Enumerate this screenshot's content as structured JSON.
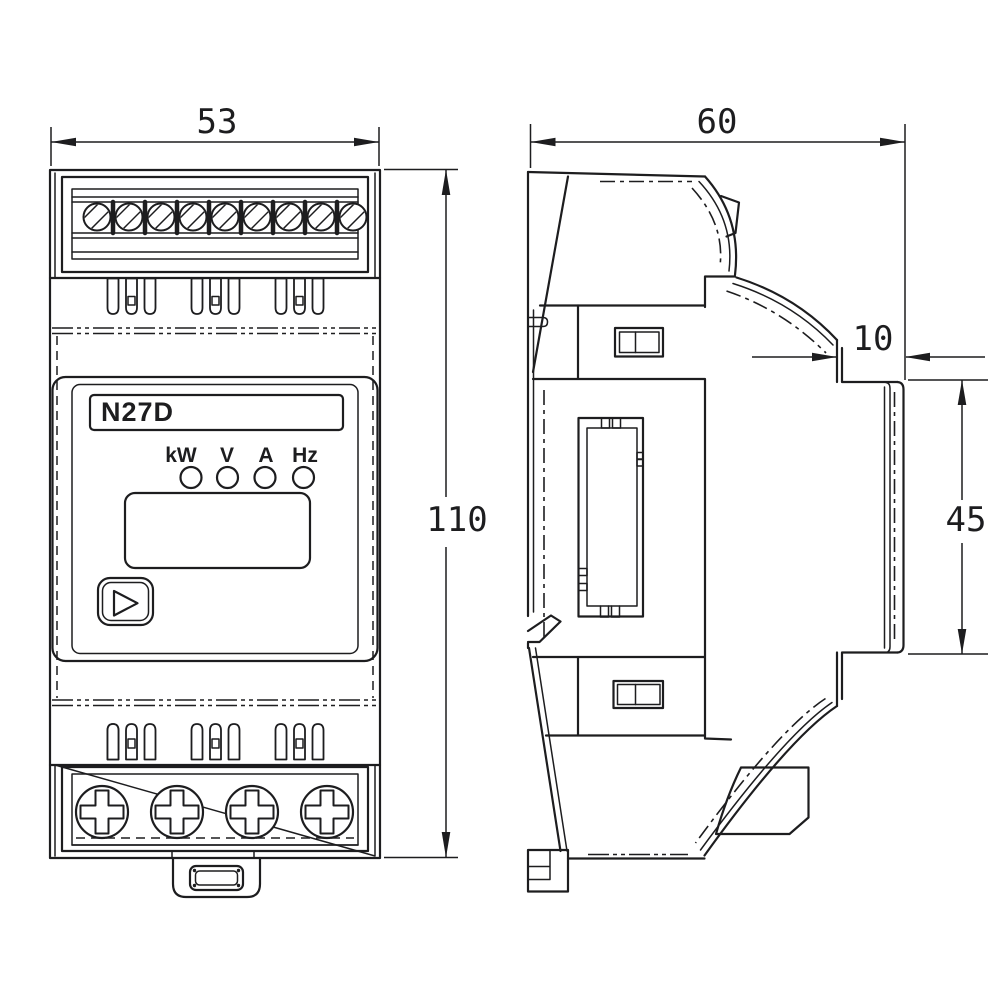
{
  "drawing": {
    "ink_color": "#1d1d1f",
    "background_color": "#ffffff",
    "front_view": {
      "model_label": "N27D",
      "indicators": [
        "kW",
        "V",
        "A",
        "Hz"
      ],
      "width_dim": "53",
      "height_dim": "110"
    },
    "side_view": {
      "depth_dim": "60",
      "front_depth_dim": "10",
      "front_height_dim": "45"
    }
  }
}
